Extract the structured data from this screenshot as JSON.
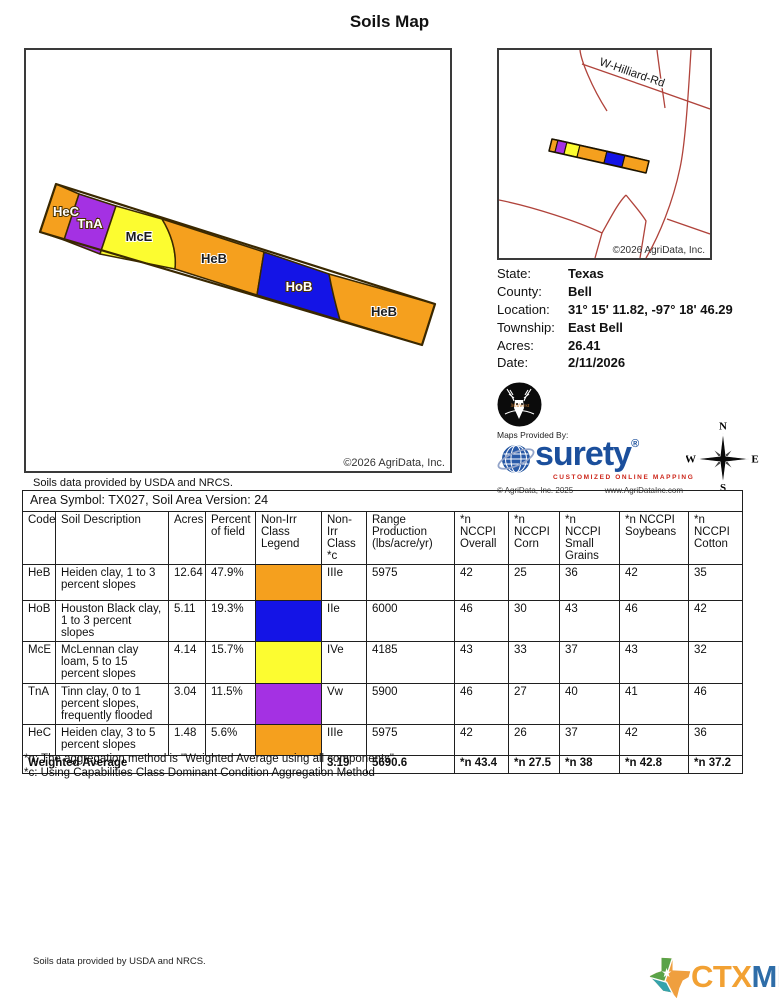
{
  "title": "Soils Map",
  "main_map": {
    "copyright": "©2026 AgriData, Inc.",
    "labels": [
      "HeC",
      "TnA",
      "McE",
      "HeB",
      "HoB",
      "HeB"
    ]
  },
  "locator_map": {
    "road_label": "W-Hilliard-Rd",
    "copyright": "©2026 AgriData, Inc."
  },
  "info": {
    "rows": [
      {
        "label": "State:",
        "value": "Texas"
      },
      {
        "label": "County:",
        "value": "Bell"
      },
      {
        "label": "Location:",
        "value": "31° 15' 11.82,  -97° 18' 46.29"
      },
      {
        "label": "Township:",
        "value": "East Bell"
      },
      {
        "label": "Acres:",
        "value": "26.41"
      },
      {
        "label": "Date:",
        "value": "2/11/2026"
      }
    ]
  },
  "branding": {
    "maps_provided_by": "Maps Provided By:",
    "surety_name": "surety",
    "surety_reg": "®",
    "surety_tagline": "CUSTOMIZED ONLINE MAPPING",
    "surety_copyright": "© AgriData, Inc. 2025",
    "surety_url": "www.AgriDataInc.com",
    "deer_text": "Midwest",
    "compass": {
      "n": "N",
      "s": "S",
      "e": "E",
      "w": "W"
    }
  },
  "soils_note": "Soils data provided by USDA and NRCS.",
  "table": {
    "area_header": "Area Symbol: TX027, Soil Area Version: 24",
    "columns": [
      "Code",
      "Soil Description",
      "Acres",
      "Percent of field",
      "Non-Irr Class Legend",
      "Non-Irr Class *c",
      "Range Production (lbs/acre/yr)",
      "*n NCCPI Overall",
      "*n NCCPI Corn",
      "*n NCCPI Small Grains",
      "*n NCCPI Soybeans",
      "*n NCCPI Cotton"
    ],
    "rows": [
      {
        "code": "HeB",
        "description": "Heiden clay, 1 to 3 percent slopes",
        "acres": "12.64",
        "percent": "47.9%",
        "legend_color": "#F5A01E",
        "class": "IIIe",
        "production": "5975",
        "overall": "42",
        "corn": "25",
        "small_grains": "36",
        "soybeans": "42",
        "cotton": "35"
      },
      {
        "code": "HoB",
        "description": "Houston Black clay, 1 to 3 percent slopes",
        "acres": "5.11",
        "percent": "19.3%",
        "legend_color": "#1414E6",
        "class": "IIe",
        "production": "6000",
        "overall": "46",
        "corn": "30",
        "small_grains": "43",
        "soybeans": "46",
        "cotton": "42"
      },
      {
        "code": "McE",
        "description": "McLennan clay loam, 5 to 15 percent slopes",
        "acres": "4.14",
        "percent": "15.7%",
        "legend_color": "#FCFC30",
        "class": "IVe",
        "production": "4185",
        "overall": "43",
        "corn": "33",
        "small_grains": "37",
        "soybeans": "43",
        "cotton": "32"
      },
      {
        "code": "TnA",
        "description": "Tinn clay, 0 to 1 percent slopes, frequently flooded",
        "acres": "3.04",
        "percent": "11.5%",
        "legend_color": "#A431E3",
        "class": "Vw",
        "production": "5900",
        "overall": "46",
        "corn": "27",
        "small_grains": "40",
        "soybeans": "41",
        "cotton": "46"
      },
      {
        "code": "HeC",
        "description": "Heiden clay, 3 to 5 percent slopes",
        "acres": "1.48",
        "percent": "5.6%",
        "legend_color": "#F5A01E",
        "class": "IIIe",
        "production": "5975",
        "overall": "42",
        "corn": "26",
        "small_grains": "37",
        "soybeans": "42",
        "cotton": "36"
      }
    ],
    "weighted_average": {
      "label": "Weighted Average",
      "class_avg": "3.19",
      "production": "5690.6",
      "overall": "*n 43.4",
      "corn": "*n 27.5",
      "small_grains": "*n 38",
      "soybeans": "*n 42.8",
      "cotton": "*n 37.2"
    }
  },
  "footnotes": [
    "*n: The aggregation method is \"Weighted Average using all components\"",
    "*c: Using Capabilities Class Dominant Condition Aggregation Method"
  ],
  "footer": {
    "note": "Soils data provided by USDA and NRCS.",
    "logo_ctx": "CTX",
    "logo_mls": "MLS"
  },
  "colors": {
    "orange": "#F5A01E",
    "blue": "#1414E6",
    "yellow": "#FCFC30",
    "purple": "#A431E3",
    "road_red": "#B0433B",
    "surety_blue": "#1B4F9C",
    "tagline_red": "#CC2418",
    "ctx_orange": "#F2A133",
    "mls_blue": "#2E6DA8"
  }
}
